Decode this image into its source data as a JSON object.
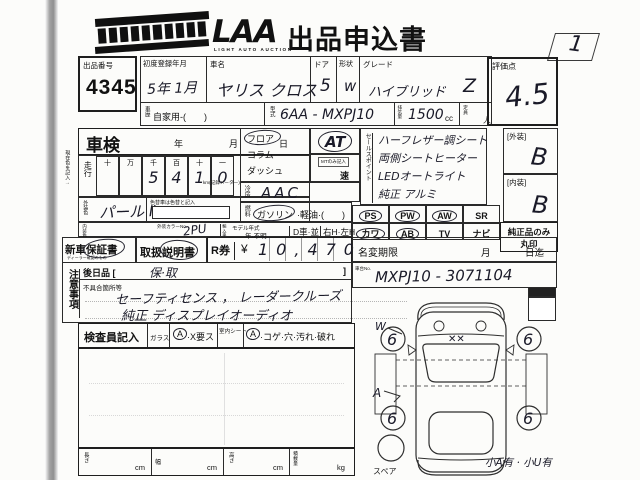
{
  "header": {
    "logo_text": "LAA",
    "logo_sub": "LIGHT AUTO AUCTION",
    "title": "出品申込書",
    "corner_value": "1"
  },
  "top": {
    "lot_label": "出品番号",
    "lot_value": "4345",
    "first_reg_label": "初度登録年月",
    "first_reg_value": "5年 1月",
    "car_name_label": "車名",
    "car_name_value": "ヤリス クロス",
    "door_label": "ドア",
    "door_value": "5",
    "shape_label": "形状",
    "shape_value": "w",
    "grade_label": "グレード",
    "grade_value": "ハイブリッド",
    "grade_value2": "Z",
    "history_label": "車歴",
    "history_value": "自家用-(　　)",
    "model_label": "型式",
    "model_value": "6AA - MXPJ10",
    "disp_label": "排気量",
    "disp_value": "1500",
    "disp_unit": "cc",
    "cap_label": "定員",
    "cap_unit": "人"
  },
  "score": {
    "label": "評価点",
    "value": "4.5",
    "ext_label": "[外装]",
    "ext_value": "B",
    "int_label": "[内装]",
    "int_value": "B",
    "genuine_line1": "純正品のみ",
    "genuine_line2": "丸印"
  },
  "shaken": {
    "label": "車検",
    "year": "年",
    "month": "月",
    "day": "日",
    "mileage_label": "走行",
    "digit_heads": [
      "十",
      "万",
      "千",
      "百",
      "十",
      "一"
    ],
    "digits": [
      "",
      "",
      "5",
      "4",
      "1",
      "0"
    ],
    "km_note": "km(記録メーター)",
    "margin_note": "現在色を記入→"
  },
  "colors": {
    "ext_label": "外装色",
    "ext_value": "パール Ⅱ",
    "change_note": "色替車は色替と記入",
    "int_label": "内装色",
    "color_no_label": "外装カラーNo.",
    "color_no_value": "2PU",
    "import_label": "輸入車",
    "model_year_label": "モデル年式",
    "model_year_opts": "年·不明",
    "d_car": "D車·並",
    "handle": "右H·左H"
  },
  "shift": {
    "opt1": "フロア",
    "opt2": "コラム",
    "opt3": "ダッシュ",
    "value": "AT",
    "mt_note": "MTのみ記入",
    "speed": "速",
    "ac_label": "冷房",
    "ac_value": "AAC",
    "fuel_label": "燃料",
    "fuel_opt1": "ガソリン",
    "fuel_opt2": "·軽油·(　　)"
  },
  "sales": {
    "label": "セールスポイント",
    "lines": [
      "ハーフレザー調シート",
      "両側シートヒーター",
      "LEDオートライト",
      "純正 アルミ"
    ]
  },
  "equip": {
    "items": [
      {
        "name": "PS",
        "sub": "(パワステ)",
        "circled": true
      },
      {
        "name": "PW",
        "sub": "(パワーウインド)",
        "circled": true
      },
      {
        "name": "AW",
        "sub": "(アルミホイール)",
        "circled": true
      },
      {
        "name": "SR",
        "sub": "(サンルーフ)",
        "circled": false
      },
      {
        "name": "カワ",
        "sub": "(カワシート)",
        "circled": true
      },
      {
        "name": "AB",
        "sub": "(エアバッグ)",
        "circled": true
      },
      {
        "name": "TV",
        "sub": "(地デジ)",
        "circled": false
      },
      {
        "name": "ナビ",
        "sub": "(ナビゲーション)",
        "circled": false
      }
    ]
  },
  "docs": {
    "warranty": "新車保証書",
    "warranty_sub": "ディーラー確認のもの",
    "manual": "取扱説明書",
    "rticket": "R券",
    "yen": "¥",
    "price": "10,470",
    "namechange_label": "名変期限",
    "namechange_month": "月",
    "namechange_day": "日迄",
    "chassis_label": "車台No.",
    "chassis_value": "MXPJ10 - 3071104"
  },
  "notes": {
    "label": "注意事項",
    "later_label": "後日品 [",
    "later_value": "保·取",
    "later_close": "]",
    "defects_label": "不具合箇所等",
    "line1": "セーフティセンス ， レーダークルーズ",
    "line2": "純正 ディスプレイオーディオ"
  },
  "inspector": {
    "label": "検査員記入",
    "glass_label": "ガラス",
    "a1": "A",
    "glass_opts": "·X要ス",
    "seat_label": "室内シート",
    "a2": "A",
    "seat_opts": "·コゲ·穴·汚れ·破れ"
  },
  "dims": {
    "len_label": "長さ",
    "len_unit": "cm",
    "wid_label": "幅",
    "wid_unit": "cm",
    "hei_label": "高さ",
    "hei_unit": "cm",
    "load_label": "積載量",
    "load_unit": "kg"
  },
  "diagram": {
    "lock_label": "ロック車",
    "spare_label": "スペア",
    "note": "小A有 · 小U有",
    "wheel1": "6",
    "wheel2": "6",
    "wheel3": "6",
    "wheel4": "6",
    "windshield_mark": "✕✕",
    "mark_w": "W",
    "mark_a": "A"
  }
}
